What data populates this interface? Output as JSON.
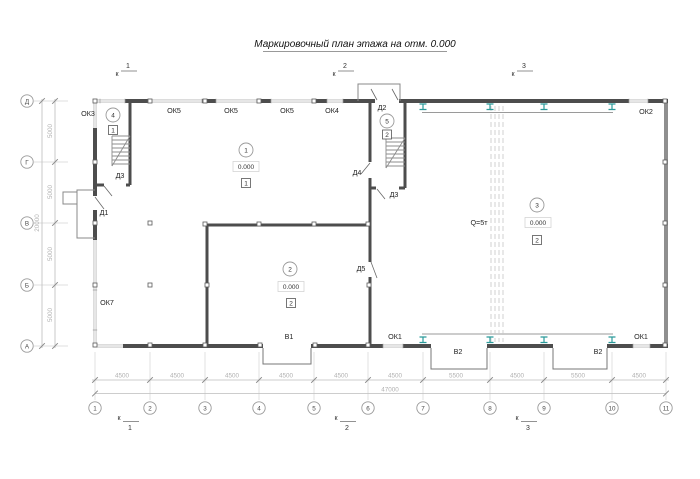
{
  "title": "Маркировочный план этажа на отм. 0.000",
  "section_marks": {
    "letter": "к",
    "top": [
      "1",
      "2",
      "3"
    ],
    "bottom": [
      "1",
      "2",
      "3"
    ]
  },
  "axes": {
    "rows": [
      "Д",
      "Г",
      "В",
      "Б",
      "А"
    ],
    "cols": [
      "1",
      "2",
      "3",
      "4",
      "5",
      "6",
      "7",
      "8",
      "9",
      "10",
      "11"
    ]
  },
  "dimensions": {
    "left_segments": [
      "5000",
      "5000",
      "5000",
      "5000"
    ],
    "left_total": "20000",
    "bottom_segments": [
      "4500",
      "4500",
      "4500",
      "4500",
      "4500",
      "4500",
      "5500",
      "4500",
      "5500",
      "4500"
    ],
    "bottom_total": "47000"
  },
  "rooms": [
    {
      "num": "1",
      "elevation": "0.000",
      "floor_type": "1"
    },
    {
      "num": "2",
      "elevation": "0.000",
      "floor_type": "2"
    },
    {
      "num": "3",
      "elevation": "0.000",
      "floor_type": "2"
    },
    {
      "num": "4",
      "floor_type": "1"
    },
    {
      "num": "5",
      "floor_type": "2"
    }
  ],
  "windows": [
    {
      "label": "ОК3"
    },
    {
      "label": "ОК5"
    },
    {
      "label": "ОК5"
    },
    {
      "label": "ОК5"
    },
    {
      "label": "ОК4"
    },
    {
      "label": "ОК2"
    },
    {
      "label": "ОК7"
    },
    {
      "label": "ОК1"
    },
    {
      "label": "ОК1"
    }
  ],
  "doors": [
    {
      "label": "Д1"
    },
    {
      "label": "Д2"
    },
    {
      "label": "Д3"
    },
    {
      "label": "Д3"
    },
    {
      "label": "Д4"
    },
    {
      "label": "Д5"
    }
  ],
  "gates": [
    {
      "label": "В1"
    },
    {
      "label": "В2"
    },
    {
      "label": "В2"
    }
  ],
  "crane": {
    "capacity_label": "Q=5т"
  },
  "colors": {
    "wall": "#4d4d4d",
    "light_wall": "#b9b9b9",
    "dimension": "#b0b0b0",
    "label": "#1f1f1f",
    "crane_beam": "#2a9a9a"
  }
}
